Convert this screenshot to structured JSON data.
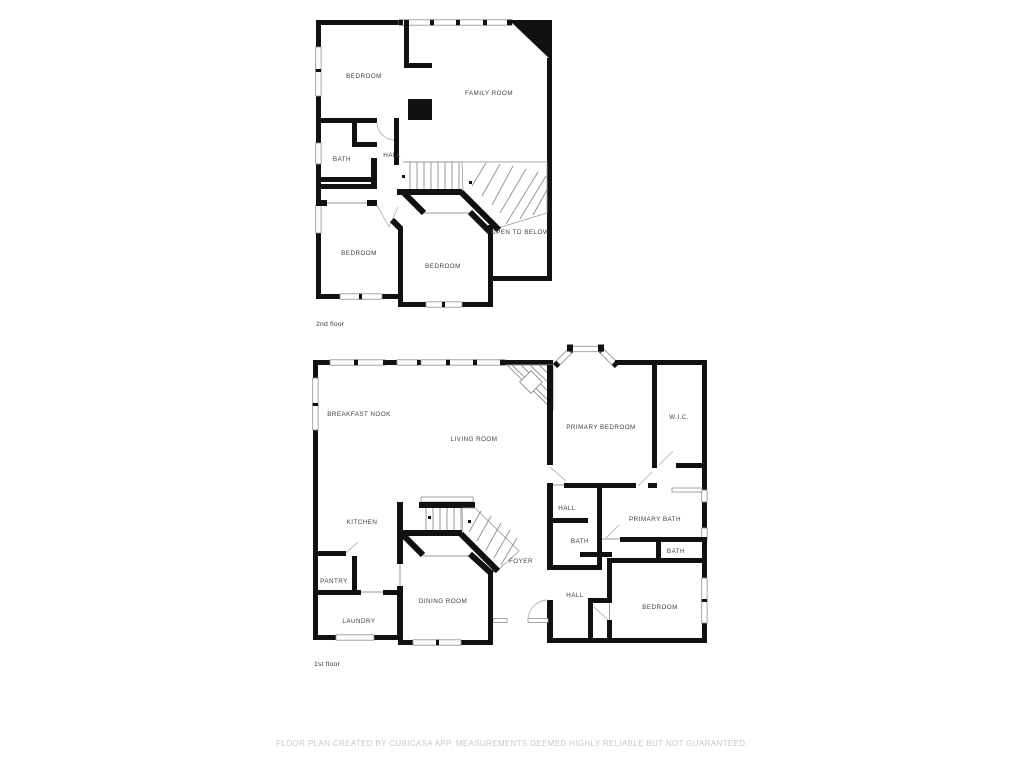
{
  "colors": {
    "wall": "#111111",
    "label": "#3f3f3f",
    "floor_label": "#333333",
    "footer": "#c8c8c8",
    "background": "#ffffff"
  },
  "floor2": {
    "label": "2nd floor",
    "rooms": {
      "bedroom_top": "BEDROOM",
      "family_room": "FAMILY ROOM",
      "bath": "BATH",
      "hall": "HALL",
      "bedroom_left": "BEDROOM",
      "bedroom_center": "BEDROOM",
      "open_to_below": "OPEN TO BELOW"
    }
  },
  "floor1": {
    "label": "1st floor",
    "rooms": {
      "breakfast_nook": "BREAKFAST NOOK",
      "living_room": "LIVING ROOM",
      "primary_bedroom": "PRIMARY BEDROOM",
      "wic": "W.I.C.",
      "kitchen": "KITCHEN",
      "hall_upper": "HALL",
      "primary_bath": "PRIMARY BATH",
      "bath_middle": "BATH",
      "bath_right": "BATH",
      "pantry": "PANTRY",
      "foyer": "FOYER",
      "dining_room": "DINING ROOM",
      "laundry": "LAUNDRY",
      "hall_lower": "HALL",
      "bedroom": "BEDROOM"
    }
  },
  "footer": "FLOOR PLAN CREATED BY CUBICASA APP. MEASUREMENTS DEEMED HIGHLY RELIABLE BUT NOT GUARANTEED."
}
